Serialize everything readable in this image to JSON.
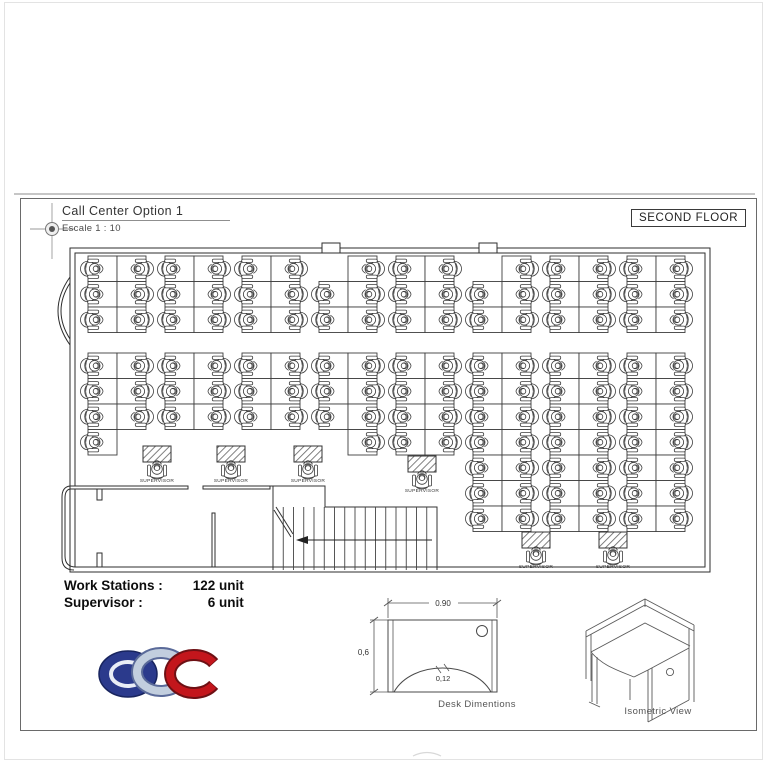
{
  "sheet": {
    "title": "Call Center Option 1",
    "scale_note": "Escale 1 : 10",
    "floor_label": "SECOND FLOOR"
  },
  "legend": {
    "workstations_label": "Work Stations :",
    "workstations_value": "122 unit",
    "supervisors_label": "Supervisor :",
    "supervisors_value": "6 unit"
  },
  "figures": {
    "desk_dimensions": {
      "caption": "Desk Dimentions",
      "width_label": "0.90",
      "depth_label": "0,6",
      "edge_label": "0,12"
    },
    "isometric": {
      "caption": "Isometric View"
    }
  },
  "plan": {
    "supervisor_label": "SUPERVISOR",
    "desk_w": 29,
    "row_h": 25.5,
    "bands": [
      {
        "y": 256,
        "clusters": [
          {
            "x": 88,
            "rows": 3
          },
          {
            "x": 165,
            "rows": 3
          },
          {
            "x": 242,
            "rows": 3
          },
          {
            "x": 319,
            "rows": 3,
            "skip": [
              [
                0,
                0
              ]
            ]
          },
          {
            "x": 396,
            "rows": 3
          },
          {
            "x": 473,
            "rows": 3,
            "skip": [
              [
                0,
                0
              ]
            ]
          },
          {
            "x": 550,
            "rows": 3
          },
          {
            "x": 627,
            "rows": 3
          }
        ]
      },
      {
        "y": 353,
        "clusters": [
          {
            "x": 88,
            "rows": 4,
            "skip": [
              [
                3,
                1
              ]
            ]
          },
          {
            "x": 165,
            "rows": 3
          },
          {
            "x": 242,
            "rows": 3
          },
          {
            "x": 319,
            "rows": 4,
            "skip": [
              [
                3,
                0
              ]
            ]
          },
          {
            "x": 396,
            "rows": 4
          },
          {
            "x": 473,
            "rows": 7
          },
          {
            "x": 550,
            "rows": 7
          },
          {
            "x": 627,
            "rows": 7
          }
        ]
      }
    ],
    "supervisors": [
      {
        "cx": 157,
        "y": 446
      },
      {
        "cx": 231,
        "y": 446
      },
      {
        "cx": 308,
        "y": 446
      },
      {
        "cx": 422,
        "y": 456
      },
      {
        "cx": 536,
        "y": 532
      },
      {
        "cx": 613,
        "y": 532
      }
    ]
  },
  "logo": {
    "letters": "CDC",
    "colors": {
      "blue": "#2b3a8c",
      "blue_outline": "#18245e",
      "silver": "#c2cede",
      "silver_outline": "#5a6a99",
      "red": "#c3161c",
      "red_outline": "#6e1014"
    }
  }
}
